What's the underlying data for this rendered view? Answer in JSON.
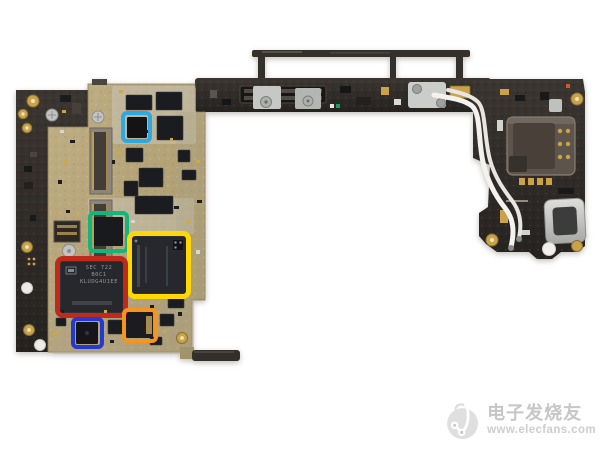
{
  "photo": {
    "subject": "smartphone-motherboard-teardown"
  },
  "highlights": [
    {
      "name": "cyan-box",
      "color": "#2ea9e0"
    },
    {
      "name": "green-box",
      "color": "#12b57a"
    },
    {
      "name": "yellow-box",
      "color": "#ffd705"
    },
    {
      "name": "red-box",
      "color": "#bf2a1d"
    },
    {
      "name": "blue-box",
      "color": "#2439cf"
    },
    {
      "name": "orange-box",
      "color": "#f7941e"
    }
  ],
  "chips": {
    "storage": {
      "line1": "SEC 722",
      "line2": "B0C1",
      "line3": "KLUDG4U1EE"
    }
  },
  "watermark": {
    "brand": "电子发烧友",
    "url": "www.elecfans.com",
    "logo": "elecfans-circuit-logo"
  }
}
